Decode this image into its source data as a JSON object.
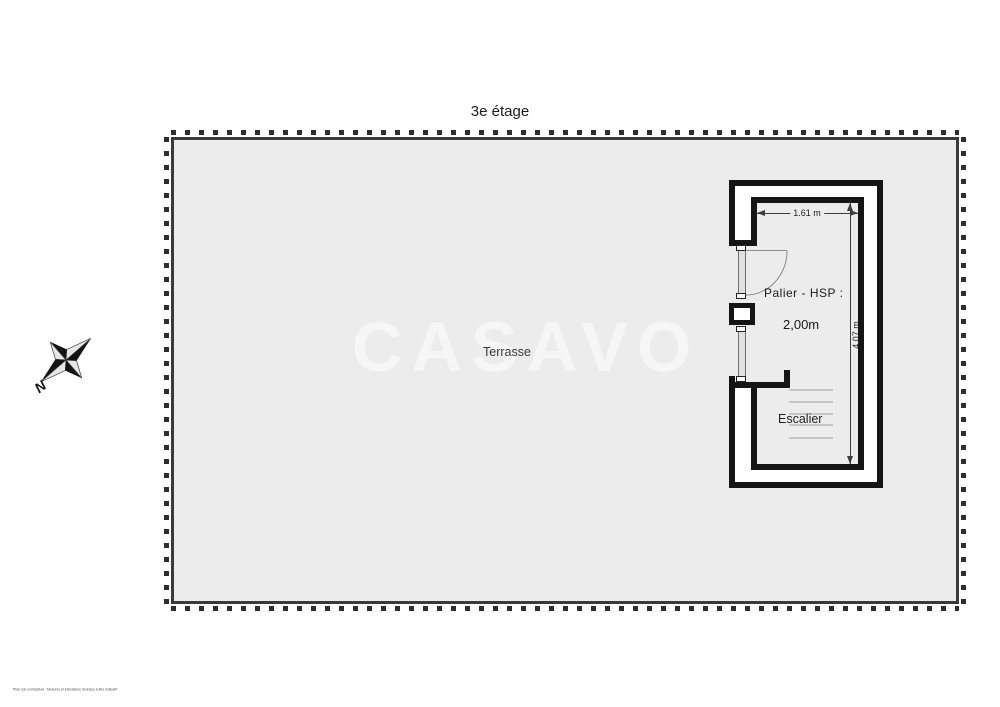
{
  "page": {
    "title": "3e étage",
    "disclaimer": "Plan non contractuel - Mesures et indications données à titre indicatif"
  },
  "watermark": {
    "text": "CASAVO",
    "color": "#f6f6f6"
  },
  "terrace": {
    "label": "Terrasse",
    "fill_color": "#ececec",
    "border_color": "#3a3a3a"
  },
  "room": {
    "name_label": "Palier - HSP :",
    "ceiling_height_value": "2,00m",
    "stairs_label": "Escalier",
    "wall_color": "#151515"
  },
  "dimensions": {
    "width_label": "1.61 m",
    "height_label": "4,07 m"
  },
  "compass": {
    "north_label": "N"
  }
}
